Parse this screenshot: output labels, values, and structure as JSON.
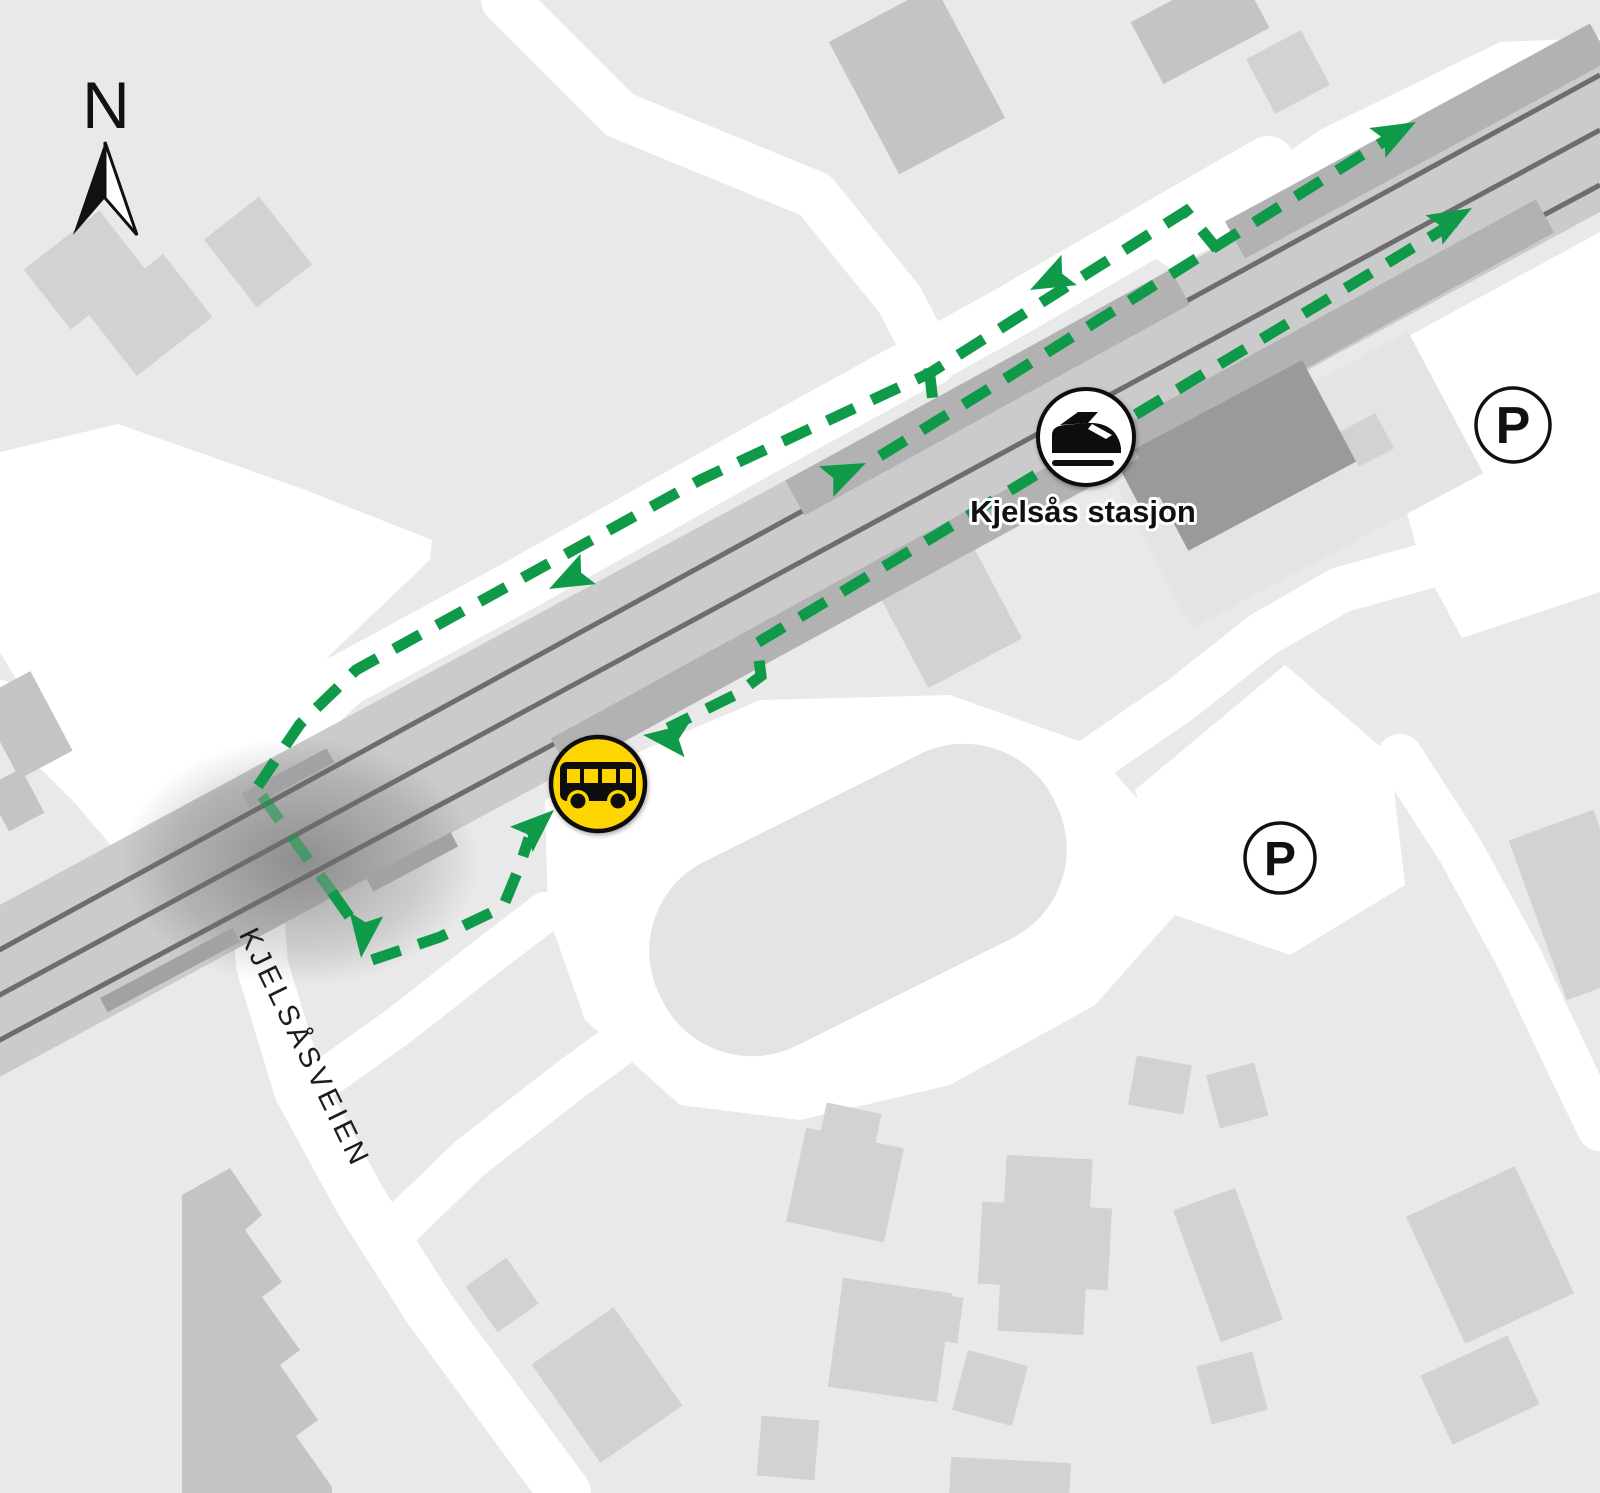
{
  "map_title": "Kjelsås stasjon area map",
  "compass": {
    "label": "N"
  },
  "labels": {
    "station": "Kjelsås stasjon",
    "street": "KJELSÅSVEIEN"
  },
  "markers": {
    "train_station": {
      "icon": "train-icon",
      "label": "Kjelsås stasjon"
    },
    "bus_stop": {
      "icon": "bus-icon"
    },
    "parking1": {
      "icon": "parking-icon",
      "label": "P"
    },
    "parking2": {
      "icon": "parking-icon",
      "label": "P"
    }
  },
  "route": {
    "style": "green-dashed-with-arrows",
    "description_arrows": [
      "northeast along tracks (2)",
      "southwest along north road (2)",
      "onto north platform",
      "west to bus stop",
      "northeast into bus stop",
      "south across bridge"
    ]
  },
  "colors": {
    "bg": "#e9e9e9",
    "road": "#ffffff",
    "building": "#d2d2d2",
    "building_medium": "#c4c4c4",
    "building_dark": "#9a9a9a",
    "band": "#cbcbcb",
    "platform": "#b2b2b2",
    "rail": "#6d6d6d",
    "green": "#0f9a49",
    "yellow": "#ffd500",
    "ink": "#111111",
    "island": "#e4e4e4"
  }
}
